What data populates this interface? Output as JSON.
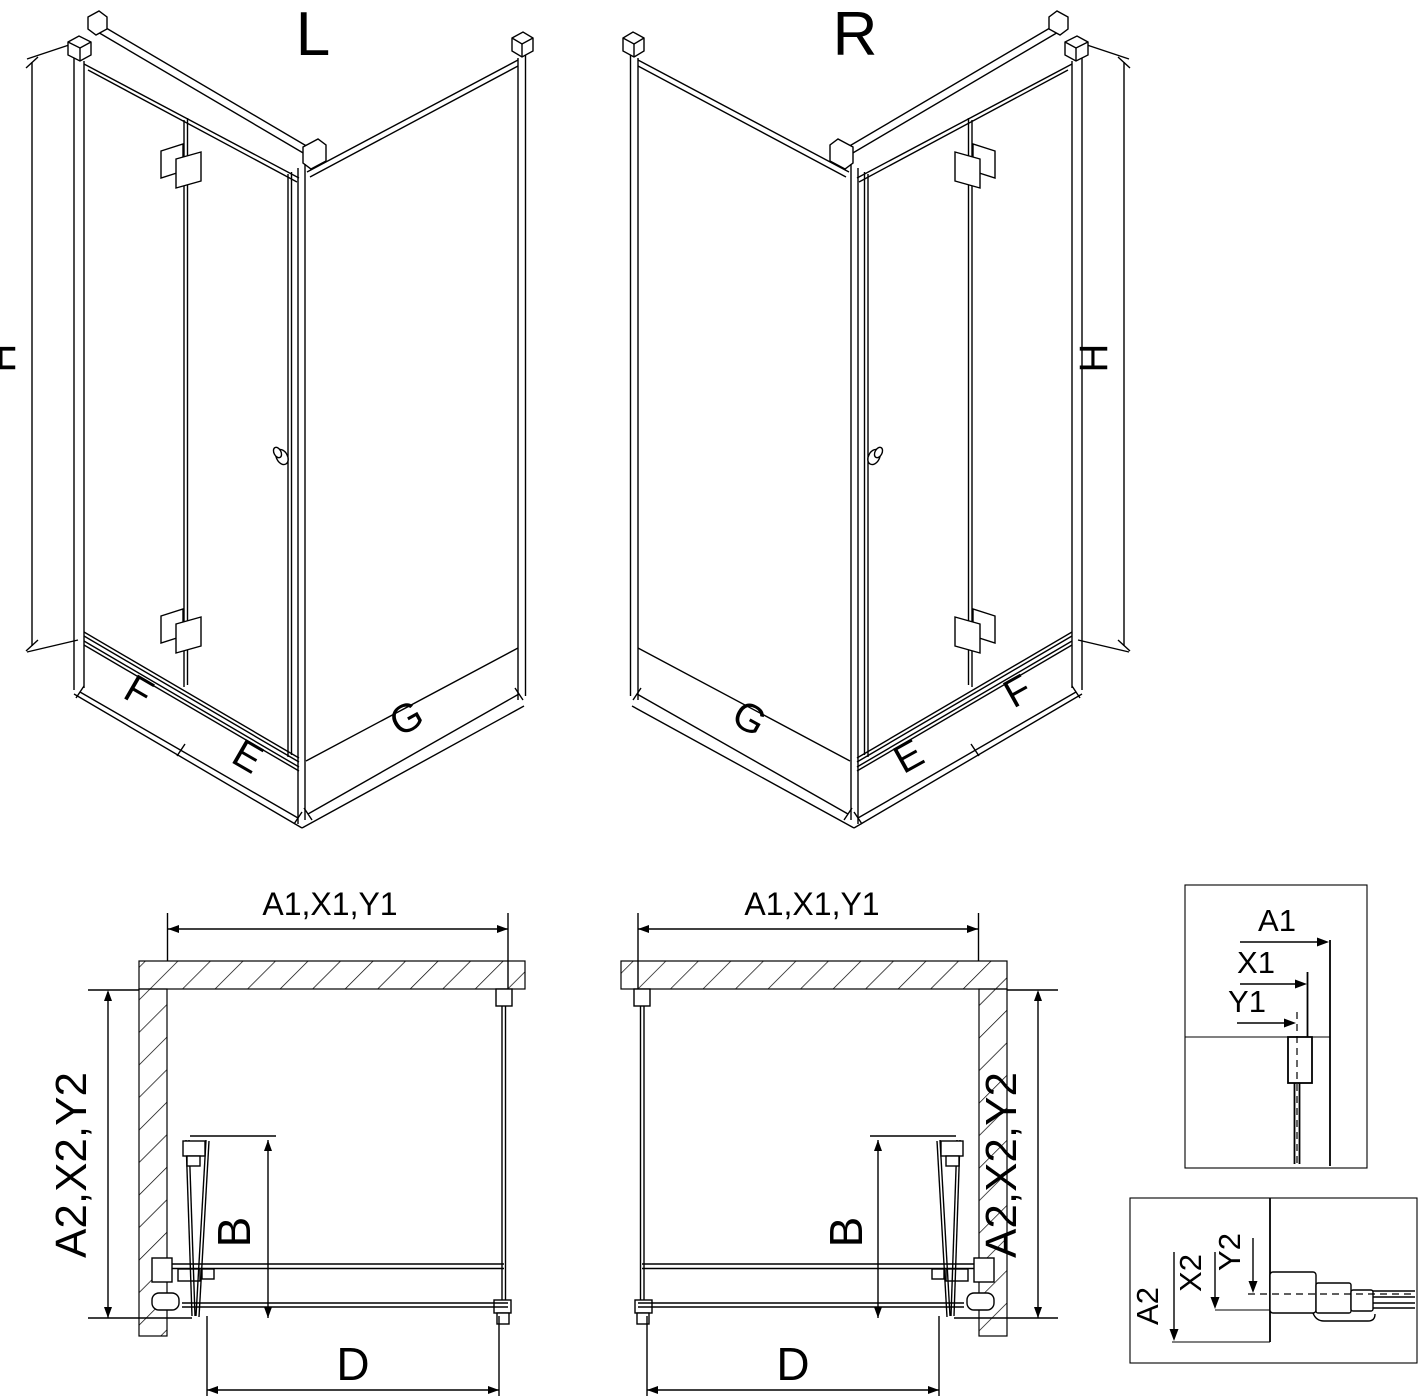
{
  "page": {
    "background_color": "#ffffff",
    "line_color": "#000000",
    "description": "Technical dimension drawing of a corner shower enclosure with bi-fold door, left (L) and right (R) versions, plan views and wall profile measurement details"
  },
  "iso_left": {
    "title": "L",
    "height_dim": "H",
    "panel1_dim": "F",
    "panel2_dim": "E",
    "side_dim": "G"
  },
  "iso_right": {
    "title": "R",
    "height_dim": "H",
    "panel1_dim": "F",
    "panel2_dim": "E",
    "side_dim": "G"
  },
  "plan_left": {
    "width_dim": "A1,X1,Y1",
    "depth_dim": "A2,X2,Y2",
    "fold_dim": "B",
    "entry_dim": "D"
  },
  "plan_right": {
    "width_dim": "A1,X1,Y1",
    "depth_dim": "A2,X2,Y2",
    "fold_dim": "B",
    "entry_dim": "D"
  },
  "detail_top": {
    "a1": "A1",
    "x1": "X1",
    "y1": "Y1"
  },
  "detail_bottom": {
    "a2": "A2",
    "x2": "X2",
    "y2": "Y2"
  }
}
